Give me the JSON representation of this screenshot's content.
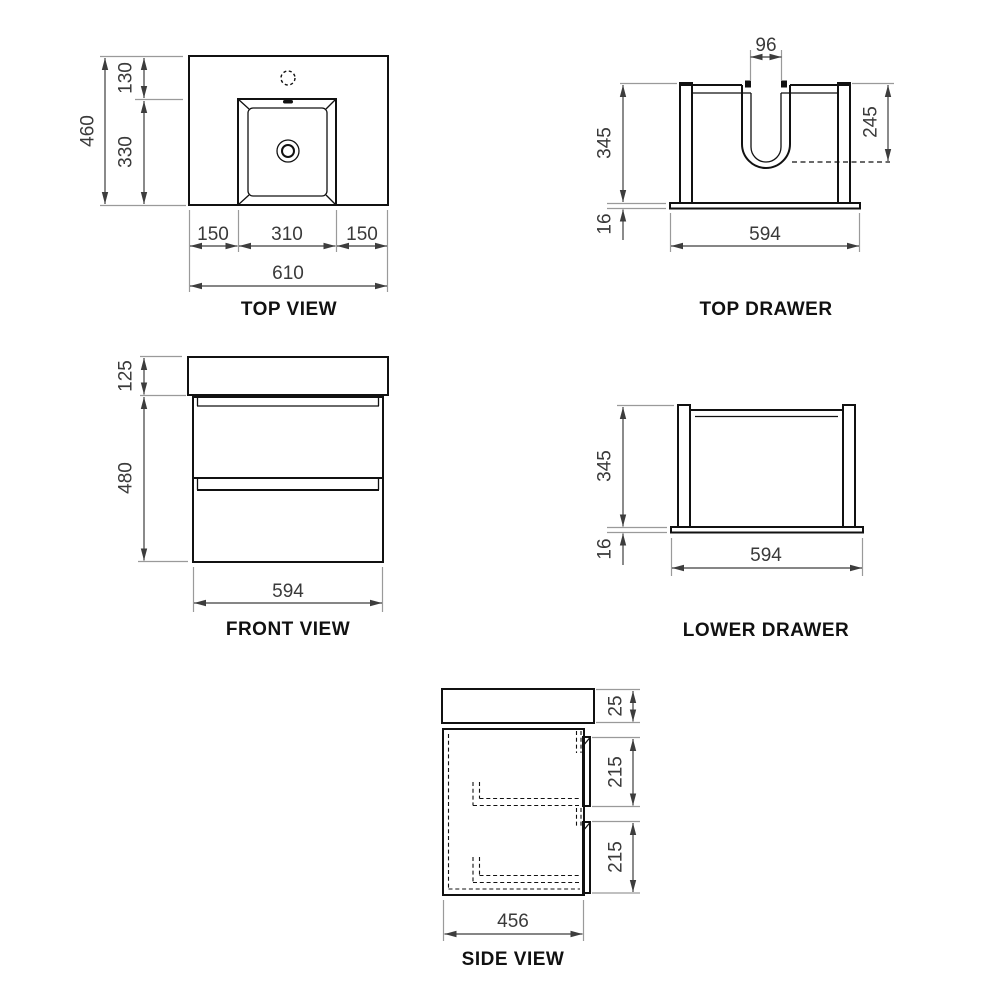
{
  "colors": {
    "geometry": "#111111",
    "dimension_line": "#3d3d3d",
    "extension_line": "#9a9a9a",
    "label_text": "#3a3a3a",
    "title_text": "#111111",
    "background": "#ffffff"
  },
  "views": {
    "top_view": {
      "title": "TOP VIEW",
      "dims": {
        "overall_depth": "460",
        "tap_to_basin": "130",
        "basin_depth": "330",
        "left_offset": "150",
        "basin_width": "310",
        "right_offset": "150",
        "overall_width": "610"
      }
    },
    "top_drawer": {
      "title": "TOP DRAWER",
      "dims": {
        "cutout_width": "96",
        "box_height": "345",
        "base_height": "16",
        "box_width": "594",
        "cutout_depth": "245"
      }
    },
    "front_view": {
      "title": "FRONT VIEW",
      "dims": {
        "basin_height": "125",
        "cabinet_height": "480",
        "cabinet_width": "594"
      }
    },
    "lower_drawer": {
      "title": "LOWER DRAWER",
      "dims": {
        "box_height": "345",
        "base_height": "16",
        "box_width": "594"
      }
    },
    "side_view": {
      "title": "SIDE VIEW",
      "dims": {
        "top_thickness": "25",
        "upper_front_height": "215",
        "lower_front_height": "215",
        "depth": "456"
      }
    }
  }
}
